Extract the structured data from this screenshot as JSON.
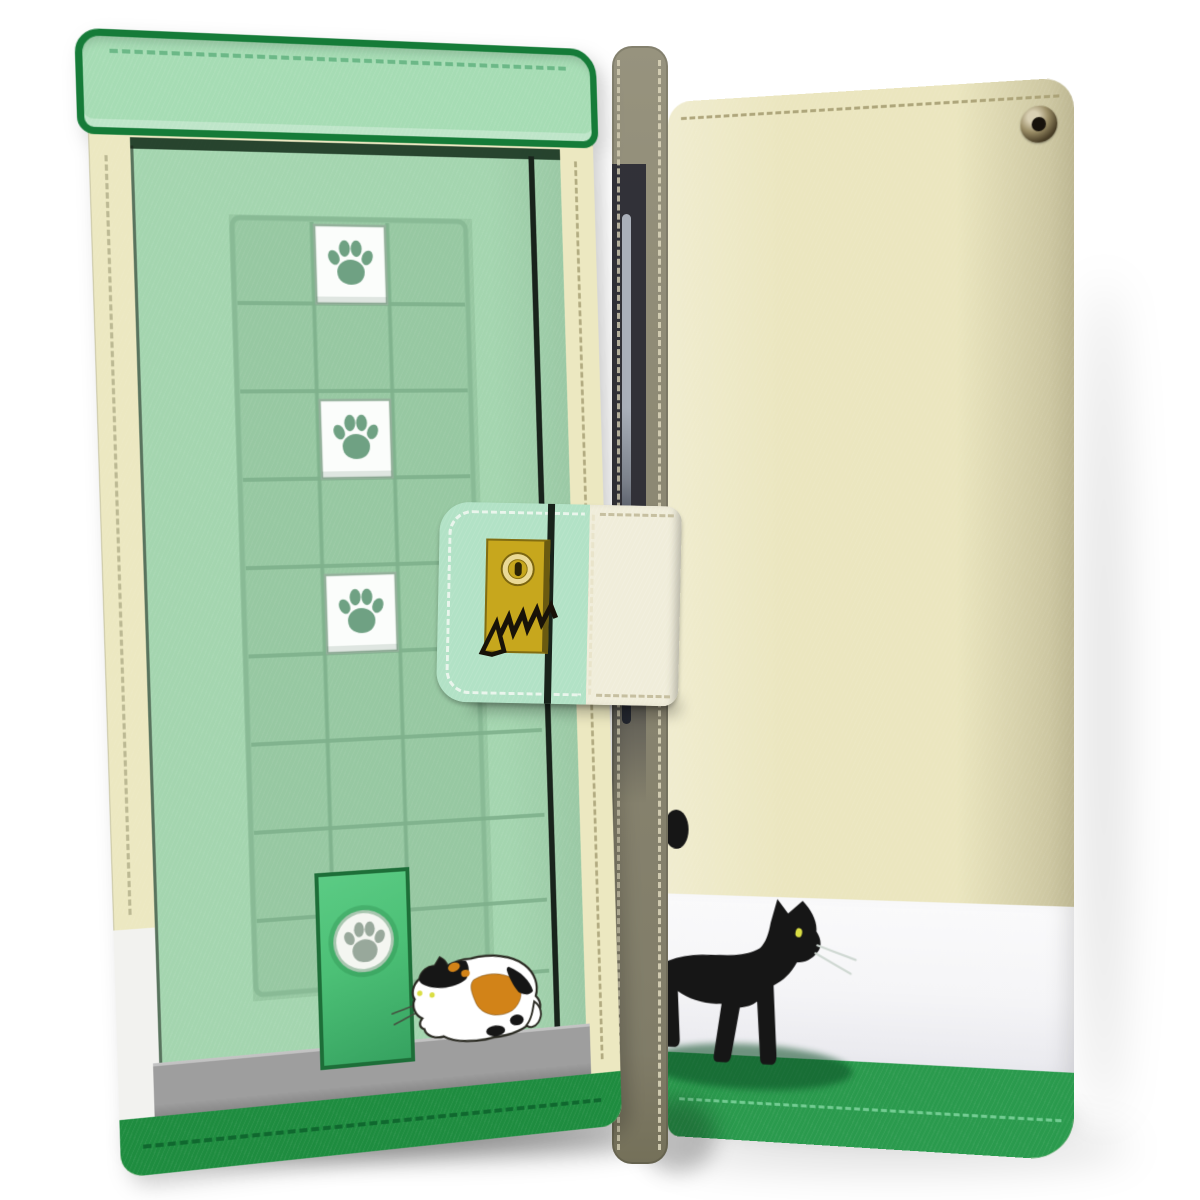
{
  "product": {
    "item": "flip-wallet-phone-case",
    "views_shown": 2,
    "front_view": "closed-front-cover-with-cat-door-illustration",
    "back_view": "back-cover-with-black-cat-illustration"
  },
  "colors": {
    "page_bg": "#ffffff",
    "front_green": "#a4d5af",
    "front_green_dark": "#97c8a2",
    "grid_line": "#7fb18c",
    "inset_border": "#88b995",
    "flap_green": "#a6dcb4",
    "flap_border": "#157b38",
    "flap_stitch": "#66b583",
    "under_flap_shadow": "#16301d",
    "door_edge_black": "#18231b",
    "cream": "#ece8c1",
    "cream_stitch": "#a9a176",
    "left_white": "#f2f2ef",
    "ledge_gray": "#9e9e9e",
    "ledge_gray_dark": "#838383",
    "band_green": "#1e8c3f",
    "band_stitch": "#0d622c",
    "catdoor_green": "#4cc076",
    "catdoor_green_dark": "#36a260",
    "catdoor_border": "#1d6e38",
    "catdoor_circle": "#f4f6f1",
    "catdoor_paw": "#98a89b",
    "paw_green": "#6fa183",
    "paw_square_white": "#fbfdfb",
    "paw_square_edge": "#94b19b",
    "gold": "#c7a71d",
    "gold_dark": "#6a5a10",
    "keyhole_ring": "#ead996",
    "keyhole_slot": "#2b2405",
    "scratch_black": "#181208",
    "clasp_green": "#b2e2c6",
    "clasp_cream": "#f0edda",
    "clasp_stitch": "#f2f8f2",
    "clasp_stitch_olive": "#c6bfa0",
    "spine_khaki": "#8e8a75",
    "spine_stitch": "#d9d3b8",
    "pen_silver": "#aab0ba",
    "back_cream": "#ebe6bf",
    "back_stitch": "#a89f74",
    "back_white": "#f5f5f7",
    "back_green": "#2a9a4d",
    "back_green_stitch": "#7fd49e",
    "cat_black": "#161616",
    "cat_eye": "#dade44",
    "whisker": "#cfd8d2",
    "calico_orange": "#d28318",
    "calico_outline": "#2b2b23",
    "cat_shadow": "rgba(10,75,35,0.55)"
  },
  "front_cover": {
    "paw_square_positions": [
      48,
      222,
      396
    ],
    "paw_square_count": 3,
    "grid_columns": [
      82.5,
      159.5
    ],
    "grid_rows": 8,
    "grid_row_spacing": 87,
    "grid_extension_from_row": 6,
    "grid_width": 244,
    "grid_extended_width": 306,
    "grid_height": 772
  },
  "icons": {
    "paw_print": "paw-print-icon",
    "keyhole": "keyhole-icon",
    "scratch_mark": "cat-scratch-icon",
    "eyelet": "eyelet-grommet-icon"
  },
  "illustrations": {
    "front_cat": "calico-cat-crouching-facing-cat-door",
    "back_cat": "black-cat-walking-right",
    "cat_door": "green-cat-door-with-paw-circle"
  }
}
